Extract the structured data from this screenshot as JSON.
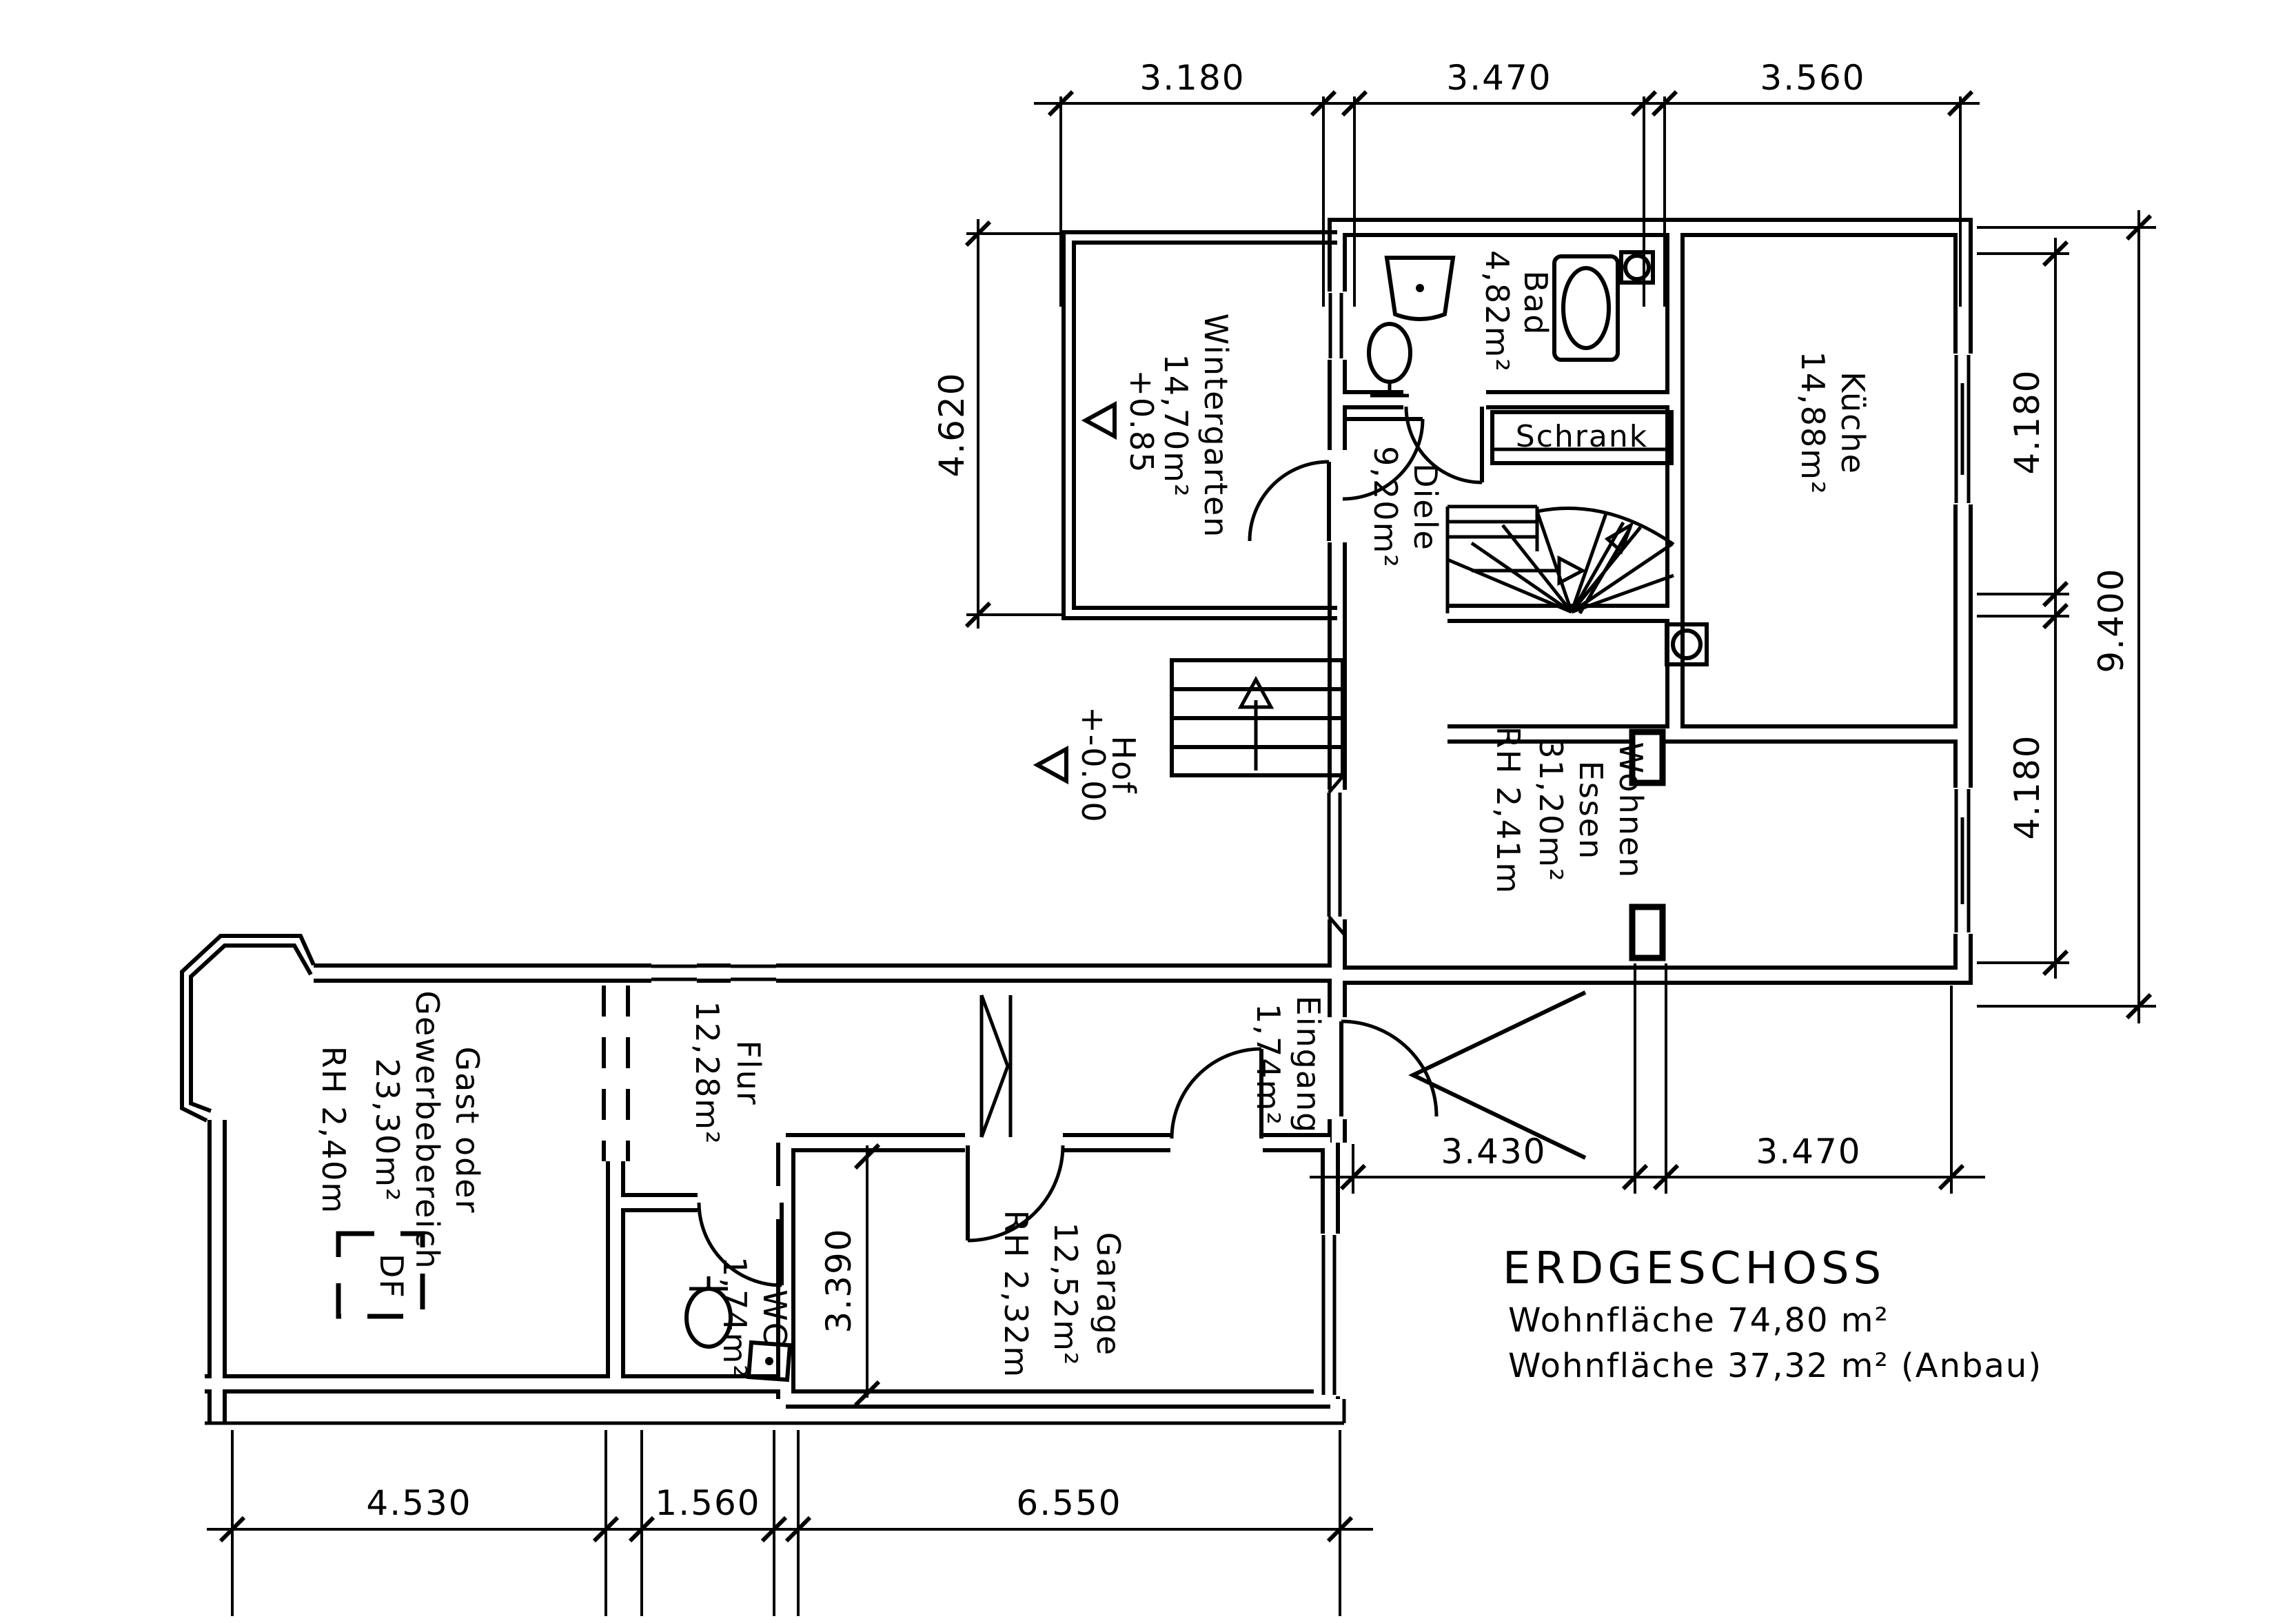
{
  "meta": {
    "drawing_type": "architectural floor plan",
    "language": "de"
  },
  "title": "ERDGESCHOSS",
  "summary": [
    "Wohnfläche  74,80  m²",
    "Wohnfläche  37,32  m²  (Anbau)"
  ],
  "rooms": {
    "wintergarten": {
      "name": "Wintergarten",
      "area": "14,70m²",
      "level": "+0.85"
    },
    "bad": {
      "name": "Bad",
      "area": "4,82m²"
    },
    "diele": {
      "name": "Diele",
      "area": "9,20m²"
    },
    "kueche": {
      "name": "Küche",
      "area": "14,88m²"
    },
    "wohnen": {
      "name": "Wohnen",
      "name2": "Essen",
      "area": "31,20m²",
      "rh": "RH 2,41m"
    },
    "hof": {
      "name": "Hof",
      "level": "+-0.00"
    },
    "eingang": {
      "name": "Eingang",
      "area": "1,74m²"
    },
    "flur": {
      "name": "Flur",
      "area": "12,28m²"
    },
    "gast": {
      "name": "Gast oder",
      "name2": "Gewerbebereich",
      "area": "23,30m²",
      "rh": "RH 2,40m"
    },
    "wc": {
      "name": "WC",
      "area": "1,74m²"
    },
    "garage": {
      "name": "Garage",
      "area": "12,52m²",
      "rh": "RH 2,32m"
    }
  },
  "labels": {
    "schrank": "Schrank",
    "df": "DF"
  },
  "dimensions": {
    "top": [
      "3.180",
      "3.470",
      "3.560"
    ],
    "right_inner": [
      "4.180",
      "4.180"
    ],
    "right_outer": "9.400",
    "left": "4.620",
    "middle": [
      "3.430",
      "3.470"
    ],
    "bottom": [
      "4.530",
      "1.560",
      "6.550"
    ],
    "garage_depth": "3.390"
  },
  "colors": {
    "line": "#000000",
    "background": "#ffffff"
  }
}
